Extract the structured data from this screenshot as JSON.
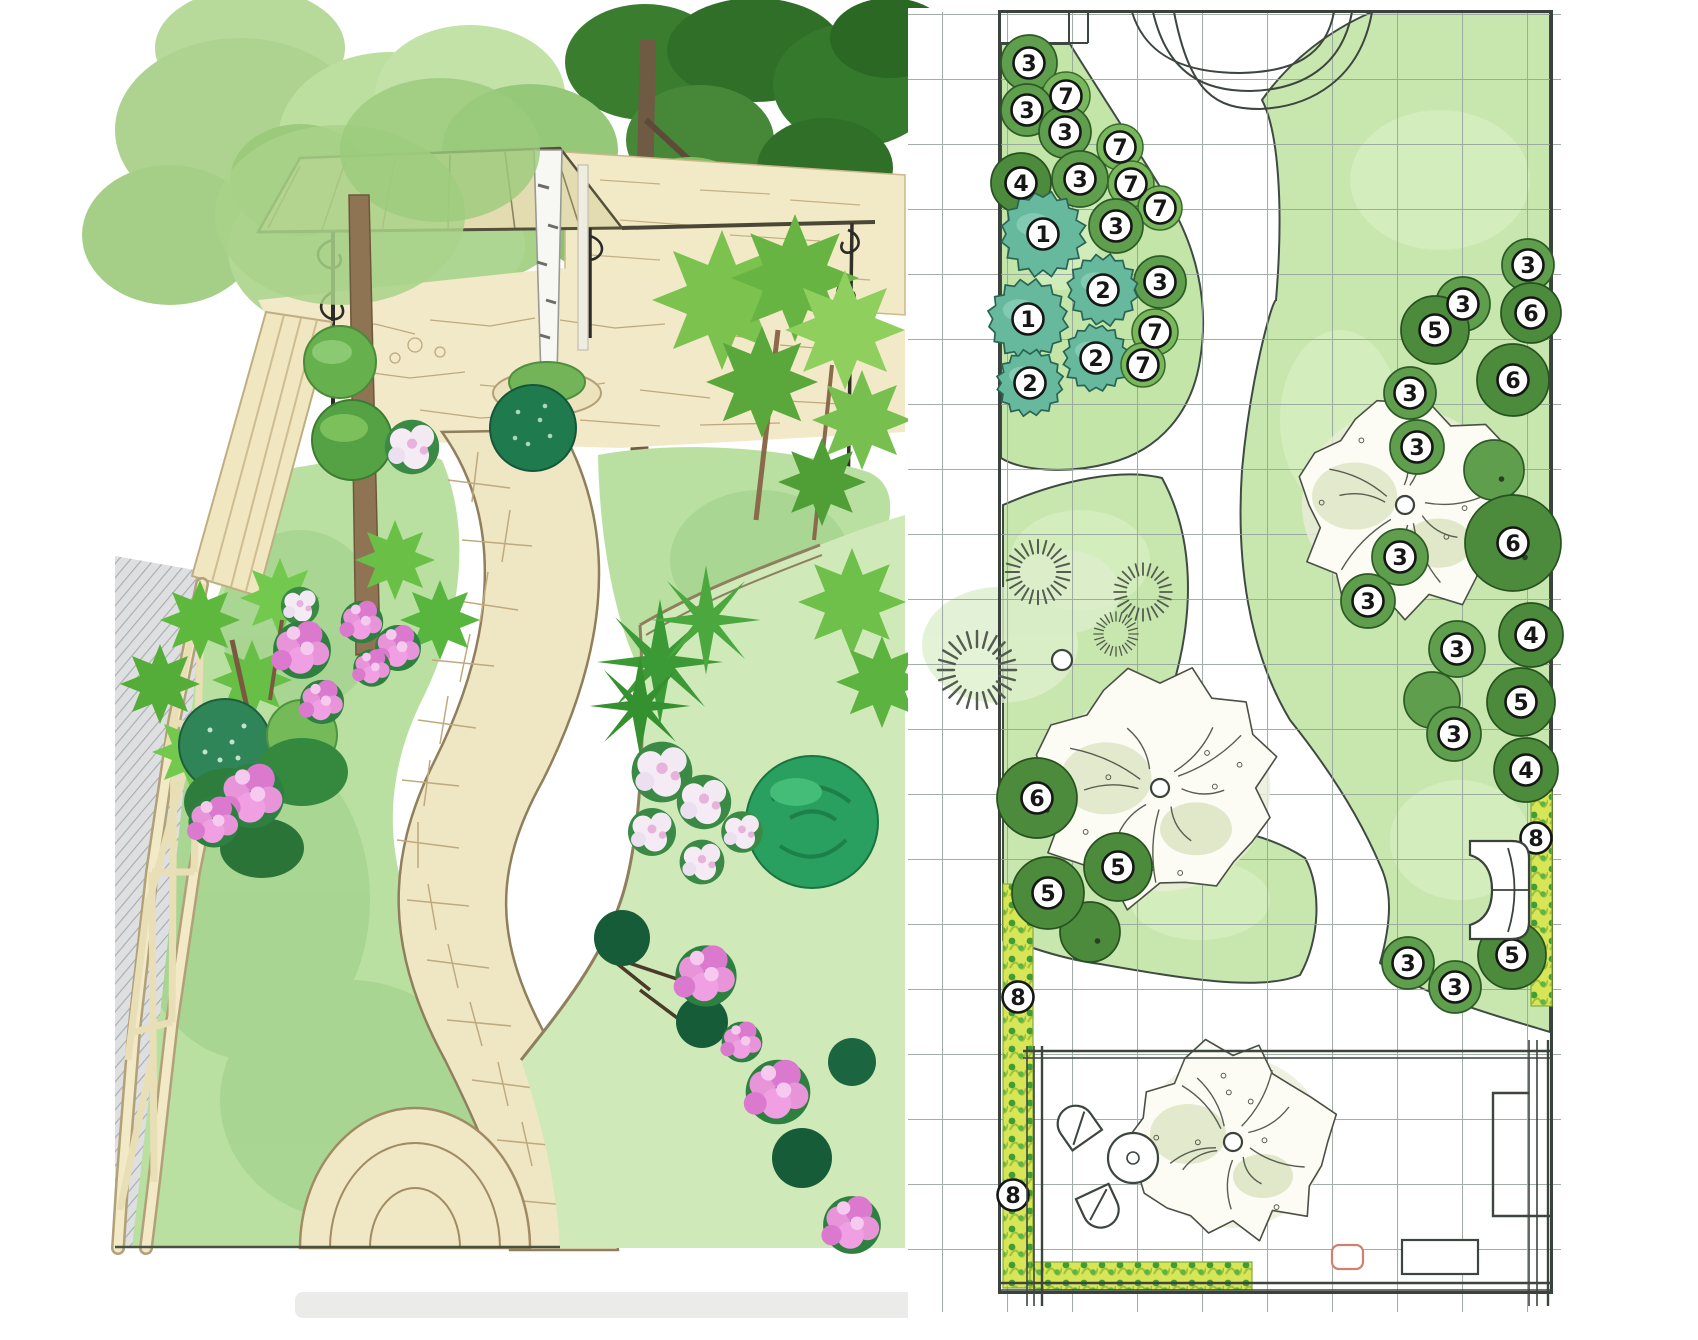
{
  "plan": {
    "grid": {
      "cell": 65
    },
    "colors": {
      "lawn": "#c8e7ae",
      "bed": "#c3e6a8",
      "grid_line": "#93a09a",
      "border": "#39423c",
      "tree_green": "#5f9e4c",
      "tree_dark": "#4c8a3c",
      "tree_light": "#79b75d",
      "tree_teal": "#67b99e",
      "hedge_yellow": "#d7e556",
      "marker_bg": "#ffffff",
      "marker_border": "#161616",
      "accent_red": "#cd8171"
    },
    "markers": [
      {
        "label": "3",
        "x": 1029,
        "y": 63,
        "r": 28,
        "kind": "green"
      },
      {
        "label": "7",
        "x": 1066,
        "y": 96,
        "r": 24,
        "kind": "light"
      },
      {
        "label": "3",
        "x": 1027,
        "y": 110,
        "r": 26,
        "kind": "green"
      },
      {
        "label": "3",
        "x": 1065,
        "y": 132,
        "r": 26,
        "kind": "green"
      },
      {
        "label": "7",
        "x": 1120,
        "y": 147,
        "r": 23,
        "kind": "light"
      },
      {
        "label": "4",
        "x": 1021,
        "y": 183,
        "r": 30,
        "kind": "dark"
      },
      {
        "label": "3",
        "x": 1080,
        "y": 179,
        "r": 28,
        "kind": "green"
      },
      {
        "label": "7",
        "x": 1131,
        "y": 184,
        "r": 23,
        "kind": "light"
      },
      {
        "label": "7",
        "x": 1160,
        "y": 208,
        "r": 22,
        "kind": "light"
      },
      {
        "label": "1",
        "x": 1043,
        "y": 234,
        "r": 38,
        "kind": "teal"
      },
      {
        "label": "3",
        "x": 1116,
        "y": 226,
        "r": 27,
        "kind": "green"
      },
      {
        "label": "3",
        "x": 1160,
        "y": 282,
        "r": 26,
        "kind": "green"
      },
      {
        "label": "2",
        "x": 1103,
        "y": 290,
        "r": 32,
        "kind": "teal"
      },
      {
        "label": "1",
        "x": 1028,
        "y": 319,
        "r": 36,
        "kind": "teal"
      },
      {
        "label": "7",
        "x": 1155,
        "y": 332,
        "r": 23,
        "kind": "light"
      },
      {
        "label": "2",
        "x": 1096,
        "y": 358,
        "r": 30,
        "kind": "teal"
      },
      {
        "label": "7",
        "x": 1143,
        "y": 365,
        "r": 22,
        "kind": "light"
      },
      {
        "label": "2",
        "x": 1030,
        "y": 383,
        "r": 30,
        "kind": "teal"
      },
      {
        "label": "3",
        "x": 1528,
        "y": 265,
        "r": 26,
        "kind": "green"
      },
      {
        "label": "3",
        "x": 1463,
        "y": 304,
        "r": 27,
        "kind": "green"
      },
      {
        "label": "6",
        "x": 1531,
        "y": 313,
        "r": 30,
        "kind": "dark"
      },
      {
        "label": "5",
        "x": 1435,
        "y": 330,
        "r": 34,
        "kind": "dark"
      },
      {
        "label": "6",
        "x": 1513,
        "y": 380,
        "r": 36,
        "kind": "dark"
      },
      {
        "label": "3",
        "x": 1410,
        "y": 393,
        "r": 26,
        "kind": "green"
      },
      {
        "label": "3",
        "x": 1417,
        "y": 447,
        "r": 27,
        "kind": "green"
      },
      {
        "label": "6",
        "x": 1513,
        "y": 543,
        "r": 48,
        "kind": "dark"
      },
      {
        "label": "3",
        "x": 1400,
        "y": 557,
        "r": 28,
        "kind": "green"
      },
      {
        "label": "3",
        "x": 1368,
        "y": 601,
        "r": 27,
        "kind": "green"
      },
      {
        "label": "4",
        "x": 1531,
        "y": 635,
        "r": 32,
        "kind": "dark"
      },
      {
        "label": "3",
        "x": 1457,
        "y": 649,
        "r": 28,
        "kind": "green"
      },
      {
        "label": "5",
        "x": 1521,
        "y": 702,
        "r": 34,
        "kind": "dark"
      },
      {
        "label": "3",
        "x": 1454,
        "y": 734,
        "r": 27,
        "kind": "green"
      },
      {
        "label": "4",
        "x": 1526,
        "y": 770,
        "r": 32,
        "kind": "dark"
      },
      {
        "label": "8",
        "x": 1536,
        "y": 838,
        "r": 0,
        "kind": "hedge"
      },
      {
        "label": "5",
        "x": 1512,
        "y": 955,
        "r": 34,
        "kind": "dark"
      },
      {
        "label": "3",
        "x": 1408,
        "y": 963,
        "r": 26,
        "kind": "green"
      },
      {
        "label": "3",
        "x": 1455,
        "y": 987,
        "r": 26,
        "kind": "green"
      },
      {
        "label": "6",
        "x": 1037,
        "y": 798,
        "r": 40,
        "kind": "dark"
      },
      {
        "label": "5",
        "x": 1118,
        "y": 867,
        "r": 34,
        "kind": "dark"
      },
      {
        "label": "5",
        "x": 1048,
        "y": 893,
        "r": 36,
        "kind": "dark"
      },
      {
        "label": "8",
        "x": 1018,
        "y": 997,
        "r": 0,
        "kind": "hedge"
      },
      {
        "label": "8",
        "x": 1013,
        "y": 1195,
        "r": 0,
        "kind": "hedge"
      }
    ],
    "filler_trees": [
      {
        "x": 1494,
        "y": 470,
        "r": 30,
        "kind": "green"
      },
      {
        "x": 1432,
        "y": 700,
        "r": 28,
        "kind": "green"
      },
      {
        "x": 1090,
        "y": 932,
        "r": 30,
        "kind": "dark"
      }
    ],
    "sketch_trees": [
      {
        "x": 1405,
        "y": 505,
        "r": 112
      },
      {
        "x": 1160,
        "y": 788,
        "r": 120
      },
      {
        "x": 1233,
        "y": 1142,
        "r": 100
      }
    ],
    "grasses": [
      {
        "x": 977,
        "y": 670,
        "s": 1.15
      },
      {
        "x": 1038,
        "y": 572,
        "s": 0.95
      },
      {
        "x": 1143,
        "y": 592,
        "s": 0.85
      },
      {
        "x": 1116,
        "y": 634,
        "s": 0.65
      }
    ],
    "grass_small_tree": {
      "x": 1062,
      "y": 660,
      "r": 10
    },
    "hedge_strips": [
      {
        "x": 1003,
        "y": 884,
        "w": 30,
        "h": 404
      },
      {
        "x": 1030,
        "y": 1262,
        "w": 222,
        "h": 28
      },
      {
        "x": 1531,
        "y": 792,
        "w": 21,
        "h": 214
      }
    ]
  },
  "illustration": {
    "palette": {
      "canopy_light": "#b3d896",
      "canopy_mid": "#8fc46f",
      "canopy_dark": "#2f7029",
      "lawn": "#b9e0a1",
      "path_stone": "#efe7c4",
      "stone_line": "#a08b62",
      "fence": "#f1e7c2",
      "pink_bloom": "#e794d9",
      "white_bloom": "#f5ebf5",
      "emerald_shrub": "#29a05f",
      "trunk": "#8f7454",
      "iron": "#2b2b28"
    }
  }
}
